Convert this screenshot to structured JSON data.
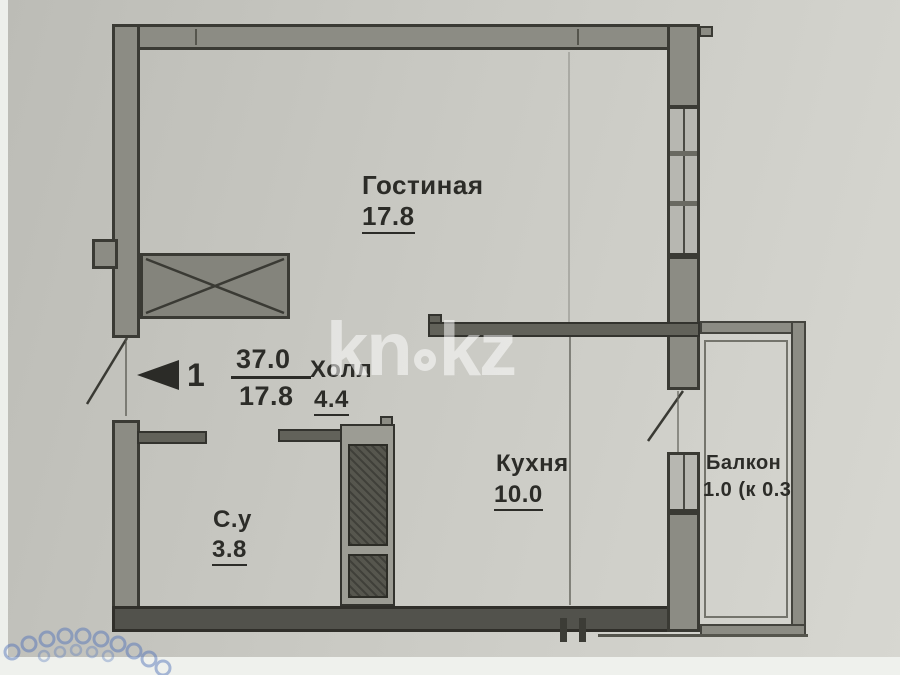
{
  "floorplan": {
    "marker": {
      "number": "1",
      "total_area": "37.0",
      "living_area": "17.8"
    },
    "rooms": {
      "living": {
        "name": "Гостиная",
        "area": "17.8"
      },
      "hall": {
        "name": "Холл",
        "area": "4.4"
      },
      "kitchen": {
        "name": "Кухня",
        "area": "10.0"
      },
      "bathroom": {
        "name": "С.у",
        "area": "3.8"
      },
      "balcony": {
        "name": "Балкон",
        "area": "1.0 (к 0.3"
      }
    },
    "watermark": {
      "left": "kn",
      "right": "kz"
    },
    "colors": {
      "paper": "#c9c9c3",
      "wall_fill": "#8c8c84",
      "wall_dark": "#52524c",
      "outline": "#3a3a34",
      "text": "#2c2c28",
      "watermark": "rgba(255,255,255,0.52)",
      "stamp_blue": "#4a6db8"
    }
  }
}
